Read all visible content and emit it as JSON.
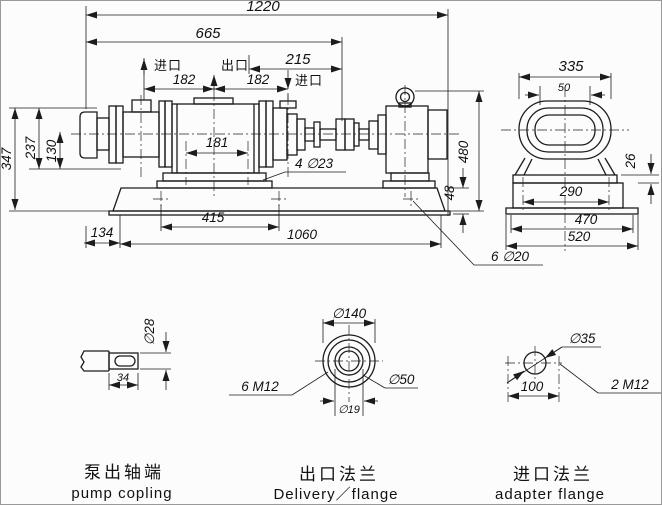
{
  "main_view": {
    "dim_total_length": "1220",
    "dim_pump_assembly_length": "665",
    "dim_inlet_to_end": "215",
    "label_inlet_left": "进口",
    "label_outlet": "出口",
    "label_inlet_right": "进口",
    "dim_port_spacing_left": "182",
    "dim_port_spacing_right": "182",
    "dim_overall_height": "347",
    "dim_height_237": "237",
    "dim_height_130": "130",
    "dim_foot_hole_spacing": "181",
    "label_foot_holes": "4  ∅23",
    "dim_shaft_to_base": "134",
    "dim_foot_span": "415",
    "dim_base_length": "1060",
    "dim_motor_height": "480",
    "dim_base_height": "48",
    "label_base_holes": "6  ∅20"
  },
  "end_view": {
    "dim_width": "335",
    "dim_top_slot": "50",
    "dim_plate_thickness": "26",
    "dim_foot_spacing": "290",
    "dim_base_470": "470",
    "dim_base_width": "520"
  },
  "shaft_detail": {
    "dim_shaft_diameter": "∅28",
    "dim_key_length": "34",
    "caption_zh": "泵出轴端",
    "caption_en": "pump copling"
  },
  "delivery_flange_detail": {
    "dim_outer_diameter": "∅140",
    "label_bolt_holes": "6  M12",
    "dim_boss_diameter": "∅50",
    "dim_bore_diameter": "∅19",
    "caption_zh": "出口法兰",
    "caption_en": "Delivery／flange"
  },
  "adapter_flange_detail": {
    "dim_bore_diameter": "∅35",
    "dim_hole_spacing": "100",
    "label_bolt_holes": "2  M12",
    "caption_zh": "进口法兰",
    "caption_en": "adapter flange"
  }
}
